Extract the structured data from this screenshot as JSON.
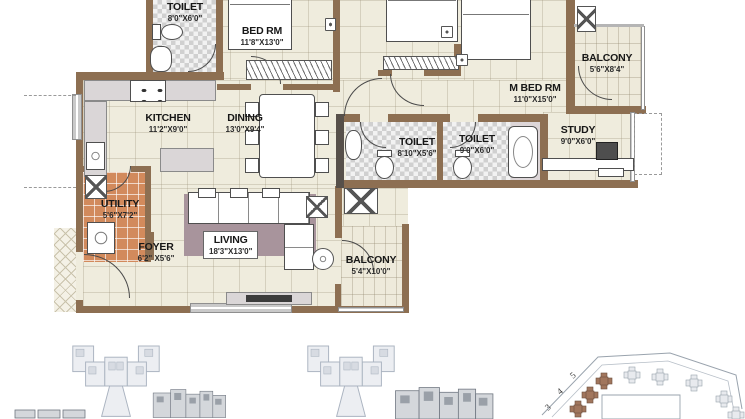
{
  "rooms": {
    "toilet_top": {
      "name": "TOILET",
      "dims": "8'0\"X6'0\""
    },
    "bed_rm": {
      "name": "BED RM",
      "dims": "11'8\"X13'0\""
    },
    "m_bed_rm": {
      "name": "M BED RM",
      "dims": "11'0\"X15'0\""
    },
    "balcony_top": {
      "name": "BALCONY",
      "dims": "5'6\"X8'4\""
    },
    "kitchen": {
      "name": "KITCHEN",
      "dims": "11'2\"X9'0\""
    },
    "dining": {
      "name": "DINING",
      "dims": "13'0\"X9'4\""
    },
    "utility": {
      "name": "UTILITY",
      "dims": "5'6\"X7'2\""
    },
    "foyer": {
      "name": "FOYER",
      "dims": "6'2\" X5'6\""
    },
    "living": {
      "name": "LIVING",
      "dims": "18'3\"X13'0\""
    },
    "balcony_bottom": {
      "name": "BALCONY",
      "dims": "5'4\"X10'0\""
    },
    "toilet_common": {
      "name": "TOILET",
      "dims": "8'10\"X5'6\""
    },
    "toilet_master": {
      "name": "TOILET",
      "dims": "9'0\"X6'0\""
    },
    "study": {
      "name": "STUDY",
      "dims": "9'0\"X6'0\""
    }
  },
  "site_plan": {
    "tower_labels": [
      "3",
      "4",
      "5"
    ]
  },
  "colors": {
    "wall": "#8d6f52",
    "floor": "#efecdd",
    "utility_tile": "#d28a5c",
    "rug": "#a8949c",
    "toilet_tile": "#d0d0d0",
    "key_plan_gray": "#aab3c0",
    "site_highlight": "#a1765d"
  }
}
